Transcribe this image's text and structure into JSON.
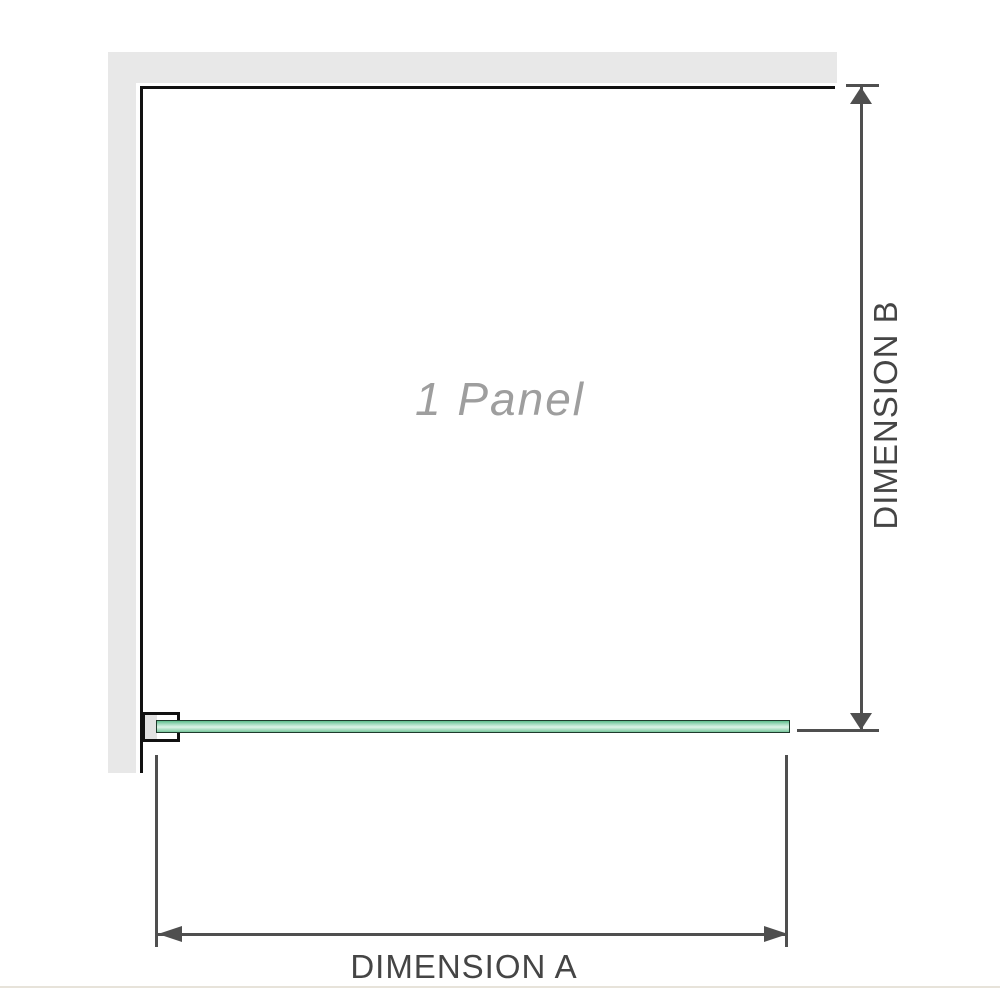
{
  "diagram": {
    "panel_label": "1 Panel",
    "dimension_a": {
      "label": "DIMENSION A"
    },
    "dimension_b": {
      "label": "DIMENSION B"
    }
  },
  "icons": {
    "dimension_b_up_arrowhead": "arrow-up-triangle",
    "dimension_b_down_arrowhead": "arrow-down-triangle",
    "dimension_a_left_arrowhead": "arrow-left-triangle",
    "dimension_a_right_arrowhead": "arrow-right-triangle"
  },
  "colors": {
    "background": "#ffffff",
    "wall_fill": "#e8e8e8",
    "wall_edge": "#111111",
    "bracket_fill": "#e2e2e2",
    "glass_border": "#1e3a2c",
    "glass_green": "#a9ddc3",
    "glass_green_light": "#ddf3e7",
    "dimension_line": "#4f4f4f",
    "dimension_text": "#454545",
    "panel_label_text": "#9e9e9e",
    "bottom_rule": "#e7e3da"
  }
}
